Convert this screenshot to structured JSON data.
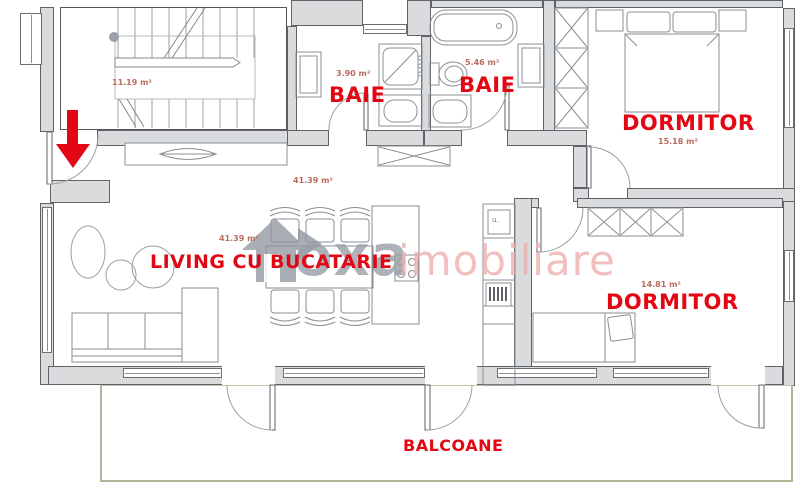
{
  "rooms": {
    "stairs": {
      "area": "11.19 m²"
    },
    "bath_small": {
      "name": "BAIE",
      "area": "3.90 m²"
    },
    "bath_large": {
      "name": "BAIE",
      "area": "5.46 m²"
    },
    "bedroom_top": {
      "name": "DORMITOR",
      "area": "15.18 m²"
    },
    "bedroom_side": {
      "name": "DORMITOR",
      "area": "14.81 m²"
    },
    "living": {
      "name": "LIVING CU BUCATARIE",
      "area_label_upper": "41.39 m²",
      "area_label_center": "41.39 m²"
    },
    "balcony": {
      "name": "BALCOANE"
    }
  },
  "kitchen": {
    "cabinet_label": "u."
  },
  "watermark": {
    "brand": "oxa",
    "suffix": "imobiliare"
  },
  "colors": {
    "label_red": "#e30613",
    "area_label_red": "#bb6a60",
    "wall_fill": "#d9dbdd",
    "wall_line": "#5f6368",
    "furniture_line": "#8a8f94",
    "balcony_line": "#b3b399",
    "watermark_gray": "#98a0a6",
    "watermark_pink": "#edb0ae"
  }
}
